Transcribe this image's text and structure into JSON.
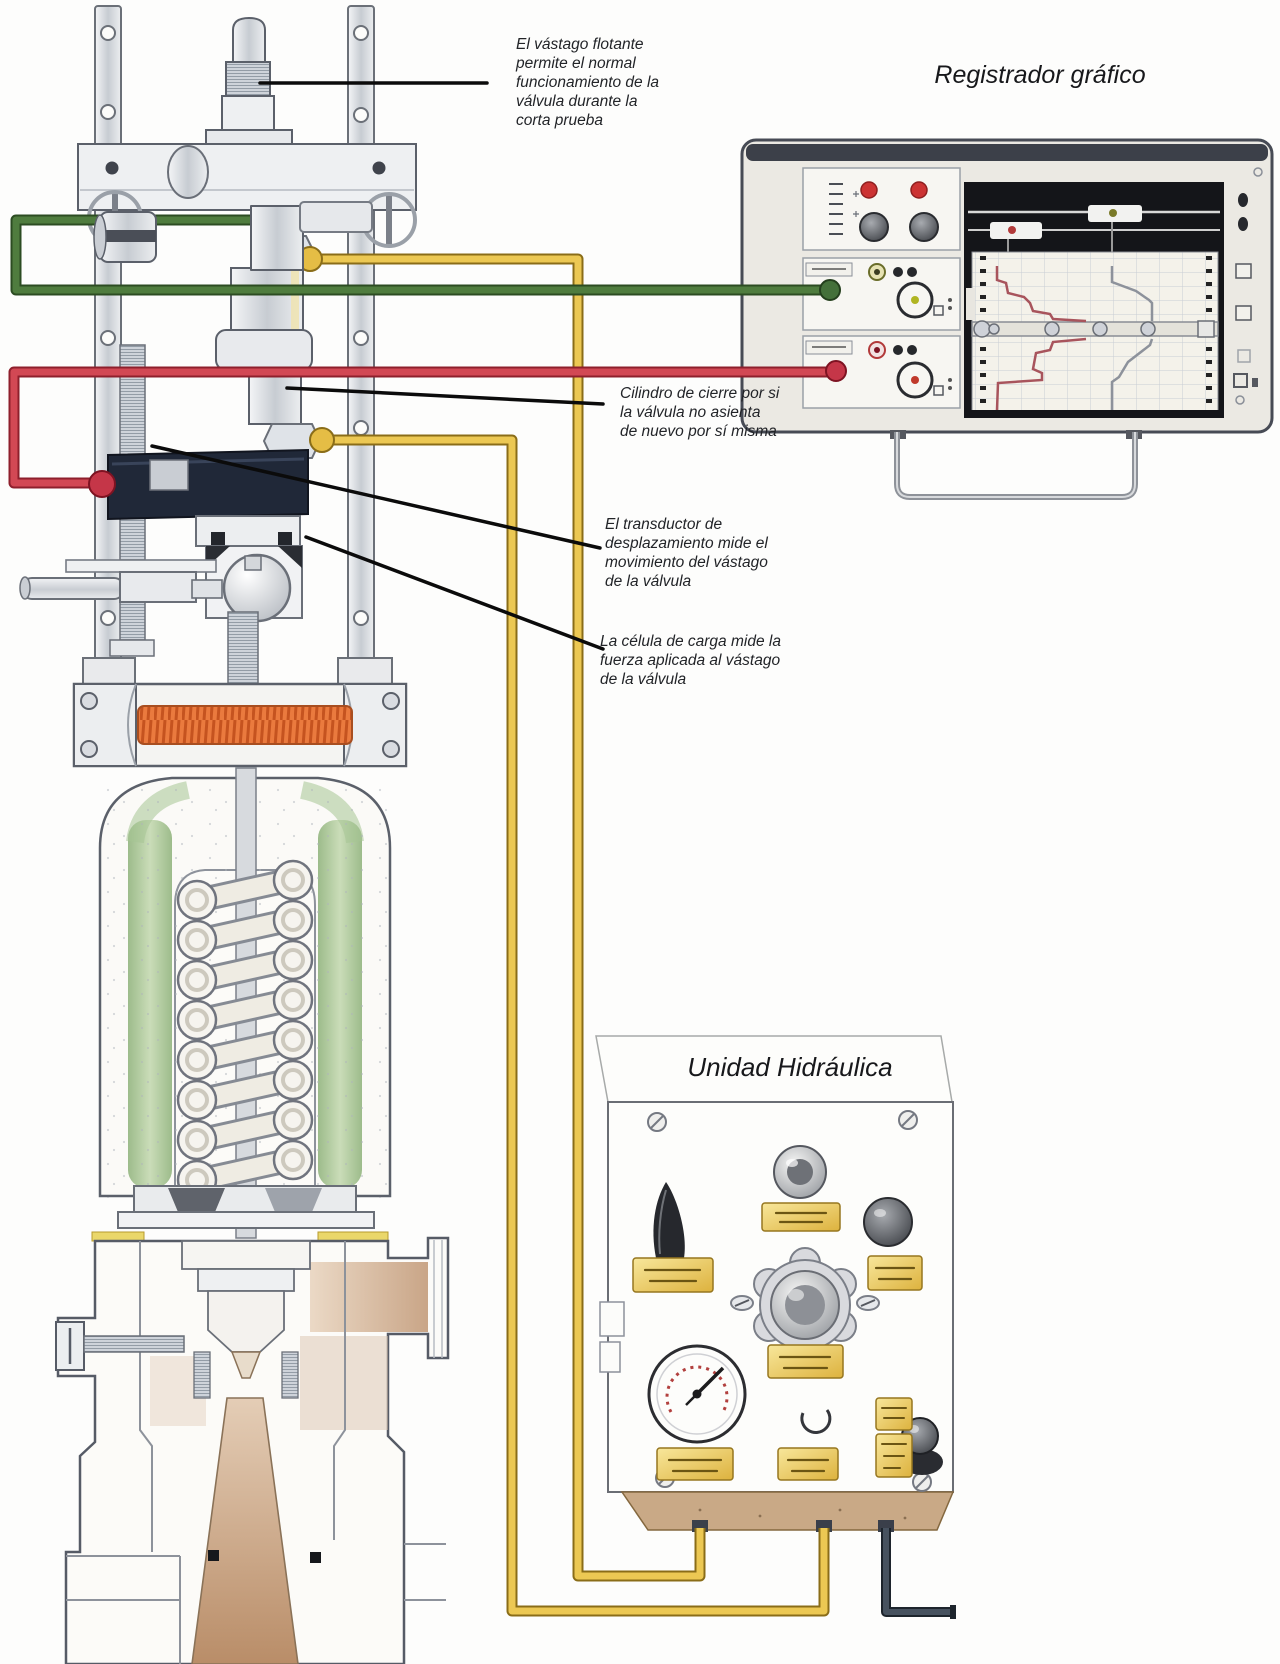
{
  "titles": {
    "recorder": "Registrador gráfico",
    "hydraulic_unit": "Unidad Hidráulica"
  },
  "annotations": {
    "floating_stem": "El vástago flotante permite el normal funcionamiento de la válvula durante la corta prueba",
    "closing_cylinder": "Cilindro de cierre por si la válvula no asienta de nuevo por sí misma",
    "displacement_transducer": "El transductor de desplazamiento mide el movimiento del vástago de la válvula",
    "load_cell": "La célula de carga mide la fuerza aplicada al vástago de la válvula"
  },
  "colors": {
    "green_cable": "#4f7c3e",
    "green_cable_edge": "#2c4c22",
    "red_cable": "#d24854",
    "red_cable_edge": "#8e1f2c",
    "yellow_cable": "#ecc853",
    "yellow_cable_edge": "#8a6d18",
    "dark_cable": "#47525f",
    "dark_cable_edge": "#1d242c",
    "coil": "#ea7a3e",
    "spring_shading": "#a6c493",
    "panel_label": "#eec84f",
    "body_shading": "#cfa98a",
    "recorder_trace_red": "#a8545c",
    "recorder_trace_gray": "#8d929b"
  }
}
